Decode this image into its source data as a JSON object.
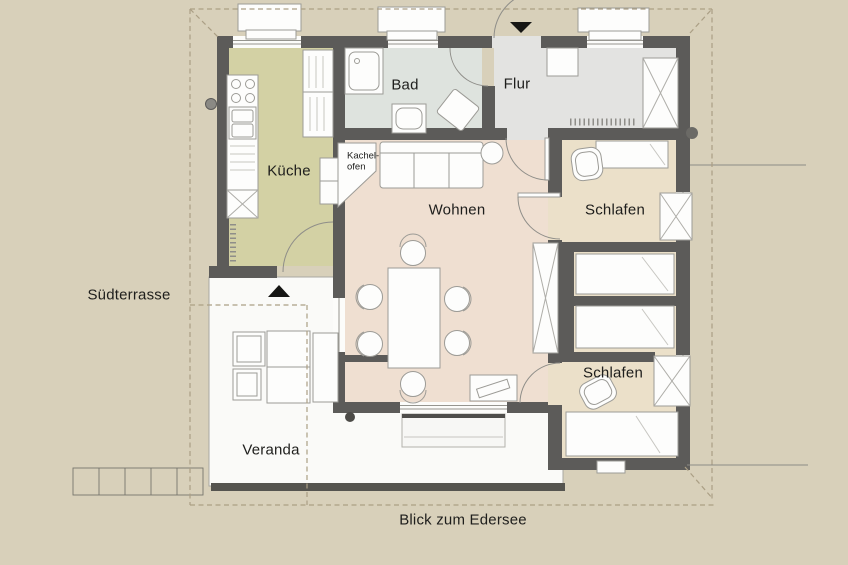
{
  "rooms": {
    "kueche": "Küche",
    "bad": "Bad",
    "flur": "Flur",
    "wohnen": "Wohnen",
    "schlafen_top": "Schlafen",
    "schlafen_bottom": "Schlafen",
    "kachelofen_line1": "Kachel-",
    "kachelofen_line2": "ofen"
  },
  "outdoor": {
    "suedterrasse": "Südterrasse",
    "veranda": "Veranda",
    "blick": "Blick zum Edersee"
  },
  "colors": {
    "site": "#d8d0ba",
    "wall": "#5c5b59",
    "kueche_floor": "#d3d1a4",
    "bad_floor": "#dee3de",
    "flur_floor": "#e3e3e1",
    "wohnen_floor": "#efdfd1",
    "schlafen_floor": "#ebe0c9",
    "veranda_floor": "#fafaf8",
    "furniture_fill": "#fdfdfc",
    "furniture_stroke": "#9c9b96",
    "dash_line": "#ab9f85",
    "text": "#1e1e1c"
  }
}
